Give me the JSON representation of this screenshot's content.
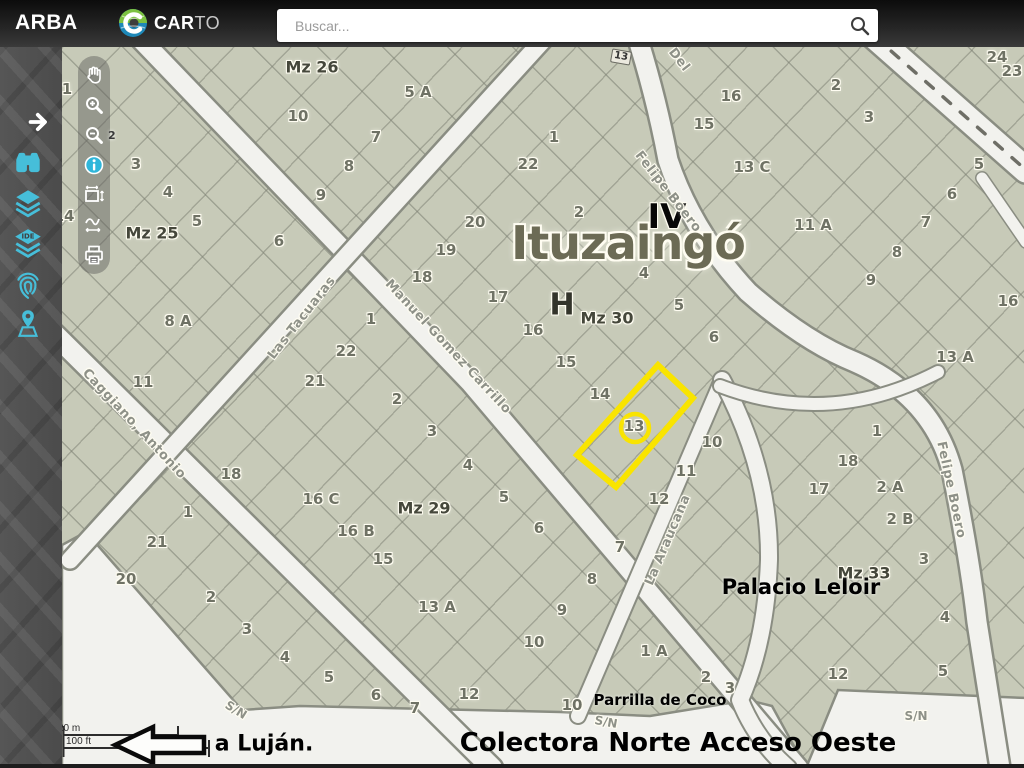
{
  "header": {
    "brand": "ARBA",
    "logo": {
      "bold": "CAR",
      "light": "TO"
    },
    "search": {
      "placeholder": "Buscar..."
    }
  },
  "sidebar": {
    "ide_text": "IDE",
    "icons": [
      "expand-arrow",
      "binoculars",
      "layers",
      "layers-ide",
      "fingerprint",
      "area-pin"
    ]
  },
  "toolbar": {
    "items": [
      "pan-hand",
      "zoom-in",
      "zoom-out",
      "info",
      "measure-area",
      "measure-path",
      "print"
    ],
    "zoom_out_badge": "2"
  },
  "colors": {
    "accent_cyan": "#46bed9",
    "info_blue": "#2fb6da",
    "highlight_yellow": "#f9e400",
    "parcel_fill": "#c7cab8",
    "street_white": "#f2f2ee"
  },
  "map": {
    "city": "Ituzaingó",
    "section": "IV",
    "zone": "H",
    "marker": "13",
    "annotations": {
      "palacio": "Palacio Leloir",
      "parrilla": "Parrilla de Coco",
      "road": "Colectora Norte Acceso Oeste",
      "direction": "a Luján."
    },
    "scale": {
      "metric": "20 m",
      "imperial": "100 ft"
    },
    "block_labels": [
      {
        "t": "Mz 26",
        "x": 312,
        "y": 67
      },
      {
        "t": "Mz 25",
        "x": 152,
        "y": 233
      },
      {
        "t": "Mz 30",
        "x": 607,
        "y": 318
      },
      {
        "t": "Mz 29",
        "x": 424,
        "y": 508
      },
      {
        "t": "Mz 33",
        "x": 864,
        "y": 573
      }
    ],
    "street_labels": [
      {
        "t": "Las Tacuaras",
        "x": 302,
        "y": 318,
        "r": -52
      },
      {
        "t": "Manuel Gomez Carrillo",
        "x": 448,
        "y": 347,
        "r": 47
      },
      {
        "t": "Caggiano, Antonio",
        "x": 134,
        "y": 424,
        "r": 47
      },
      {
        "t": "Felipe Boero",
        "x": 668,
        "y": 192,
        "r": 52
      },
      {
        "t": "Del",
        "x": 679,
        "y": 60,
        "r": 52
      },
      {
        "t": "Felipe Boero",
        "x": 951,
        "y": 490,
        "r": 78
      },
      {
        "t": "La Araucana",
        "x": 668,
        "y": 540,
        "r": -67
      }
    ],
    "sn_labels": [
      {
        "t": "S/N",
        "x": 236,
        "y": 710,
        "r": 32
      },
      {
        "t": "S/N",
        "x": 606,
        "y": 722,
        "r": 10
      },
      {
        "t": "S/N",
        "x": 916,
        "y": 716,
        "r": 0
      }
    ],
    "parcel_labels": [
      {
        "t": "10",
        "x": 298,
        "y": 116
      },
      {
        "t": "5 A",
        "x": 418,
        "y": 92
      },
      {
        "t": "7",
        "x": 376,
        "y": 137
      },
      {
        "t": "8",
        "x": 349,
        "y": 166
      },
      {
        "t": "9",
        "x": 321,
        "y": 195
      },
      {
        "t": "3",
        "x": 136,
        "y": 164
      },
      {
        "t": "4",
        "x": 168,
        "y": 192
      },
      {
        "t": "5",
        "x": 197,
        "y": 221
      },
      {
        "t": "6",
        "x": 279,
        "y": 241
      },
      {
        "t": "1",
        "x": 554,
        "y": 137
      },
      {
        "t": "22",
        "x": 528,
        "y": 164
      },
      {
        "t": "2",
        "x": 579,
        "y": 212
      },
      {
        "t": "20",
        "x": 475,
        "y": 222
      },
      {
        "t": "19",
        "x": 446,
        "y": 250
      },
      {
        "t": "18",
        "x": 422,
        "y": 277
      },
      {
        "t": "17",
        "x": 498,
        "y": 297
      },
      {
        "t": "16",
        "x": 533,
        "y": 330
      },
      {
        "t": "15",
        "x": 566,
        "y": 362
      },
      {
        "t": "14",
        "x": 600,
        "y": 394
      },
      {
        "t": "13",
        "x": 634,
        "y": 426
      },
      {
        "t": "10",
        "x": 712,
        "y": 442
      },
      {
        "t": "11",
        "x": 686,
        "y": 471
      },
      {
        "t": "12",
        "x": 659,
        "y": 499
      },
      {
        "t": "4",
        "x": 644,
        "y": 273
      },
      {
        "t": "5",
        "x": 679,
        "y": 305
      },
      {
        "t": "6",
        "x": 714,
        "y": 337
      },
      {
        "t": "16",
        "x": 731,
        "y": 96
      },
      {
        "t": "15",
        "x": 704,
        "y": 124
      },
      {
        "t": "13 C",
        "x": 752,
        "y": 167
      },
      {
        "t": "2",
        "x": 836,
        "y": 85
      },
      {
        "t": "3",
        "x": 869,
        "y": 117
      },
      {
        "t": "11 A",
        "x": 813,
        "y": 225
      },
      {
        "t": "24",
        "x": 997,
        "y": 57
      },
      {
        "t": "23",
        "x": 1012,
        "y": 71
      },
      {
        "t": "5",
        "x": 979,
        "y": 164
      },
      {
        "t": "6",
        "x": 952,
        "y": 194
      },
      {
        "t": "7",
        "x": 926,
        "y": 222
      },
      {
        "t": "8",
        "x": 897,
        "y": 252
      },
      {
        "t": "9",
        "x": 871,
        "y": 280
      },
      {
        "t": "16",
        "x": 1008,
        "y": 301
      },
      {
        "t": "13 A",
        "x": 955,
        "y": 357
      },
      {
        "t": "8 A",
        "x": 178,
        "y": 321
      },
      {
        "t": "11",
        "x": 143,
        "y": 382
      },
      {
        "t": "1",
        "x": 371,
        "y": 319
      },
      {
        "t": "22",
        "x": 346,
        "y": 351
      },
      {
        "t": "21",
        "x": 315,
        "y": 381
      },
      {
        "t": "2",
        "x": 397,
        "y": 399
      },
      {
        "t": "18",
        "x": 231,
        "y": 474
      },
      {
        "t": "16 C",
        "x": 321,
        "y": 499
      },
      {
        "t": "1",
        "x": 188,
        "y": 512
      },
      {
        "t": "3",
        "x": 432,
        "y": 431
      },
      {
        "t": "4",
        "x": 468,
        "y": 465
      },
      {
        "t": "5",
        "x": 504,
        "y": 497
      },
      {
        "t": "6",
        "x": 539,
        "y": 528
      },
      {
        "t": "16 B",
        "x": 356,
        "y": 531
      },
      {
        "t": "15",
        "x": 383,
        "y": 559
      },
      {
        "t": "13 A",
        "x": 437,
        "y": 607
      },
      {
        "t": "8",
        "x": 592,
        "y": 579
      },
      {
        "t": "9",
        "x": 562,
        "y": 610
      },
      {
        "t": "10",
        "x": 534,
        "y": 642
      },
      {
        "t": "12",
        "x": 469,
        "y": 694
      },
      {
        "t": "7",
        "x": 415,
        "y": 708
      },
      {
        "t": "21",
        "x": 157,
        "y": 542
      },
      {
        "t": "20",
        "x": 126,
        "y": 579
      },
      {
        "t": "2",
        "x": 211,
        "y": 597
      },
      {
        "t": "3",
        "x": 247,
        "y": 629
      },
      {
        "t": "4",
        "x": 285,
        "y": 657
      },
      {
        "t": "5",
        "x": 329,
        "y": 677
      },
      {
        "t": "6",
        "x": 376,
        "y": 695
      },
      {
        "t": "17",
        "x": 819,
        "y": 489
      },
      {
        "t": "7",
        "x": 620,
        "y": 547
      },
      {
        "t": "1 A",
        "x": 654,
        "y": 651
      },
      {
        "t": "2",
        "x": 706,
        "y": 677
      },
      {
        "t": "10",
        "x": 572,
        "y": 705
      },
      {
        "t": "3",
        "x": 730,
        "y": 688
      },
      {
        "t": "1",
        "x": 877,
        "y": 431
      },
      {
        "t": "18",
        "x": 848,
        "y": 461
      },
      {
        "t": "2 A",
        "x": 890,
        "y": 487
      },
      {
        "t": "2 B",
        "x": 900,
        "y": 519
      },
      {
        "t": "3",
        "x": 924,
        "y": 559
      },
      {
        "t": "4",
        "x": 945,
        "y": 617
      },
      {
        "t": "5",
        "x": 943,
        "y": 671
      },
      {
        "t": "12",
        "x": 838,
        "y": 674
      },
      {
        "t": "14",
        "x": 64,
        "y": 216
      },
      {
        "t": "1",
        "x": 67,
        "y": 89
      }
    ]
  }
}
